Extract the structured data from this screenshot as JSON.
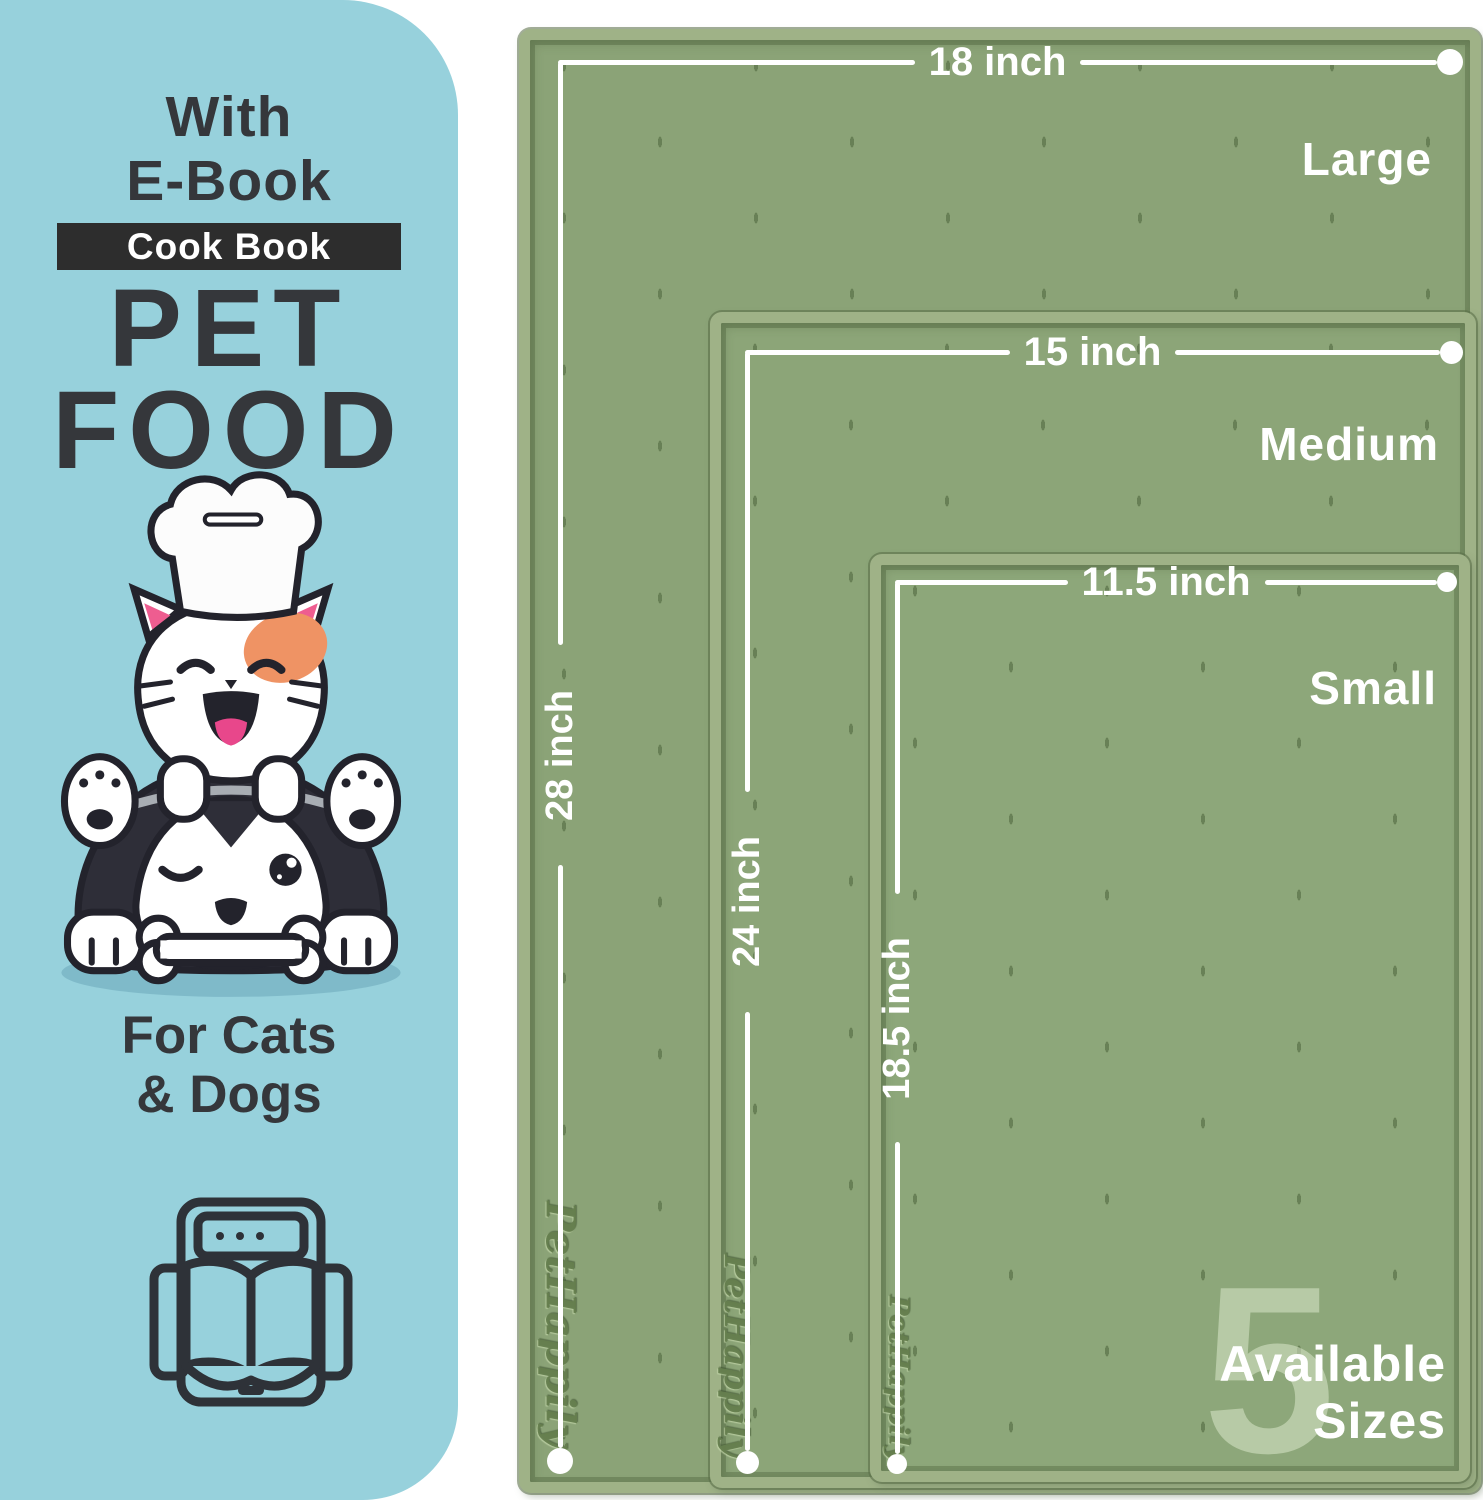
{
  "colors": {
    "panel_blue": "#97d1dc",
    "badge_dark": "#2d2d2d",
    "text_dark": "#35373b",
    "mat_green": "#8ba377",
    "mat_rim_green": "#9fb287",
    "accent_white": "#ffffff",
    "patch_orange": "#ef9364",
    "ear_pink": "#ee5d90"
  },
  "left_panel": {
    "heading_line1": "With",
    "heading_line2": "E-Book",
    "badge_label": "Cook Book",
    "title_line1": "PET",
    "title_line2": "FOOD",
    "subtitle_line1": "For Cats",
    "subtitle_line2": "& Dogs",
    "illustration": "cat-chef-on-husky-with-bone",
    "icon": "ebook-tablet-open-book-icon"
  },
  "mats": [
    {
      "size_label": "Large",
      "width_label": "18 inch",
      "height_label": "28 inch"
    },
    {
      "size_label": "Medium",
      "width_label": "15 inch",
      "height_label": "24 inch"
    },
    {
      "size_label": "Small",
      "width_label": "11.5 inch",
      "height_label": "18.5 inch"
    }
  ],
  "sizes_badge": {
    "number": "5",
    "line1": "Available",
    "line2": "Sizes"
  },
  "brand_embossed": "PetHappily"
}
